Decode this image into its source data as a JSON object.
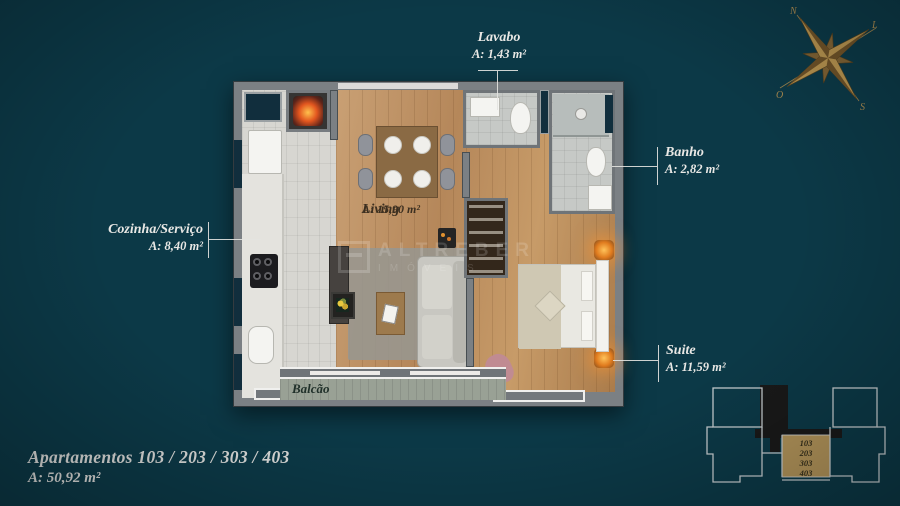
{
  "rooms": {
    "lavabo": {
      "label": "Lavabo",
      "area": "A: 1,43 m²"
    },
    "banho": {
      "label": "Banho",
      "area": "A: 2,82 m²"
    },
    "cozinha": {
      "label": "Cozinha/Serviço",
      "area": "A: 8,40 m²"
    },
    "suite": {
      "label": "Suite",
      "area": "A: 11,59 m²"
    },
    "living": {
      "label": "Living",
      "area": "A: 15,90 m²"
    },
    "balcao": {
      "label": "Balcão"
    }
  },
  "footer": {
    "title": "Apartamentos 103 / 203 / 303 / 403",
    "area": "A: 50,92 m²"
  },
  "compass": {
    "north": "N",
    "south": "S",
    "east": "L",
    "west": "O"
  },
  "keyplan": {
    "units": [
      "103",
      "203",
      "303",
      "403"
    ]
  },
  "watermark": {
    "line1": "ALTREBER",
    "line2": "IMÓVEIS"
  },
  "colors": {
    "background": "#0c3947",
    "accent_gold": "#a8894f",
    "keyplan_highlight": "#b2945a",
    "label_text": "#e9e8e5"
  }
}
